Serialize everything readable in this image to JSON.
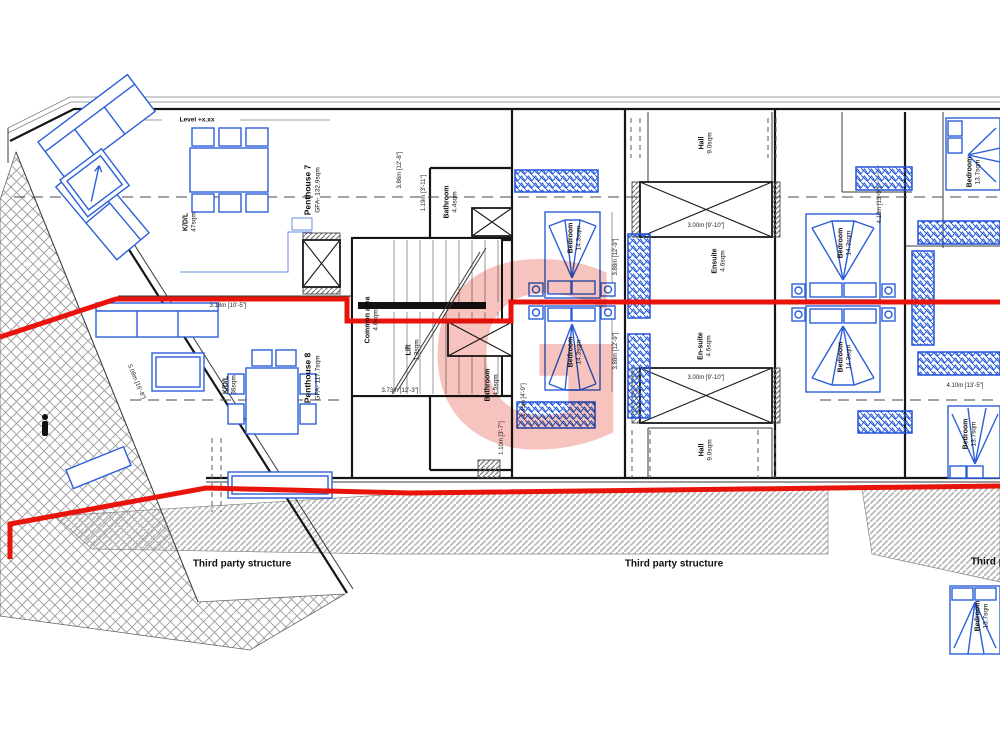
{
  "plan": {
    "level_label": "Level +x.xx",
    "watermark_letter": "G",
    "colors": {
      "route_red": "#e8140c",
      "furniture_blue": "#2b5fd9",
      "hatch_grey": "#999999"
    },
    "penthouse7": {
      "name": "Penthouse 7",
      "gfa": "GFA- 132.9sqm"
    },
    "penthouse8": {
      "name": "Penthouse 8",
      "gfa": "GFA- 117.7sqm"
    },
    "rooms": [
      {
        "name": "K/D/L",
        "area": "47sqm"
      },
      {
        "name": "K/D/L",
        "area": "36sqm"
      },
      {
        "name": "Common area",
        "area": "4.6sqm"
      },
      {
        "name": "Lift",
        "area": "1.3sqm"
      },
      {
        "name": "Bathroom",
        "area": "4.4sqm"
      },
      {
        "name": "Bathroom",
        "area": "4.5sqm"
      },
      {
        "name": "Bedroom",
        "area": "14.3sqm"
      },
      {
        "name": "Bedroom",
        "area": "14.3sqm"
      },
      {
        "name": "Bedroom",
        "area": "14.3sqm"
      },
      {
        "name": "Bedroom",
        "area": "14.3sqm"
      },
      {
        "name": "Bedroom",
        "area": "13.7sqm"
      },
      {
        "name": "Bedroom",
        "area": "13.7sqm"
      },
      {
        "name": "Bedroom",
        "area": "13.7sqm"
      },
      {
        "name": "Hall",
        "area": "9.0sqm"
      },
      {
        "name": "Hall",
        "area": "9.0sqm"
      },
      {
        "name": "Ensuite",
        "area": "4.6sqm"
      },
      {
        "name": "En-suite",
        "area": "4.6sqm"
      }
    ],
    "dimensions": [
      "5.08m [16'-8\"]",
      "3.18m [10'-5\"]",
      "3.86m [12'-8\"]",
      "1.19m [3'-11\"]",
      "3.00m [9'-10\"]",
      "3.00m [9'-10\"]",
      "3.88m [12'-9\"]",
      "3.88m [12'-9\"]",
      "4.18m [13'-9\"]",
      "4.10m [13'-5\"]",
      "3.73m [12'-3\"]",
      "1.10m [3'-7\"]",
      "1.45m [4'-9\"]"
    ],
    "notes": {
      "third_party": "Third party structure"
    }
  }
}
